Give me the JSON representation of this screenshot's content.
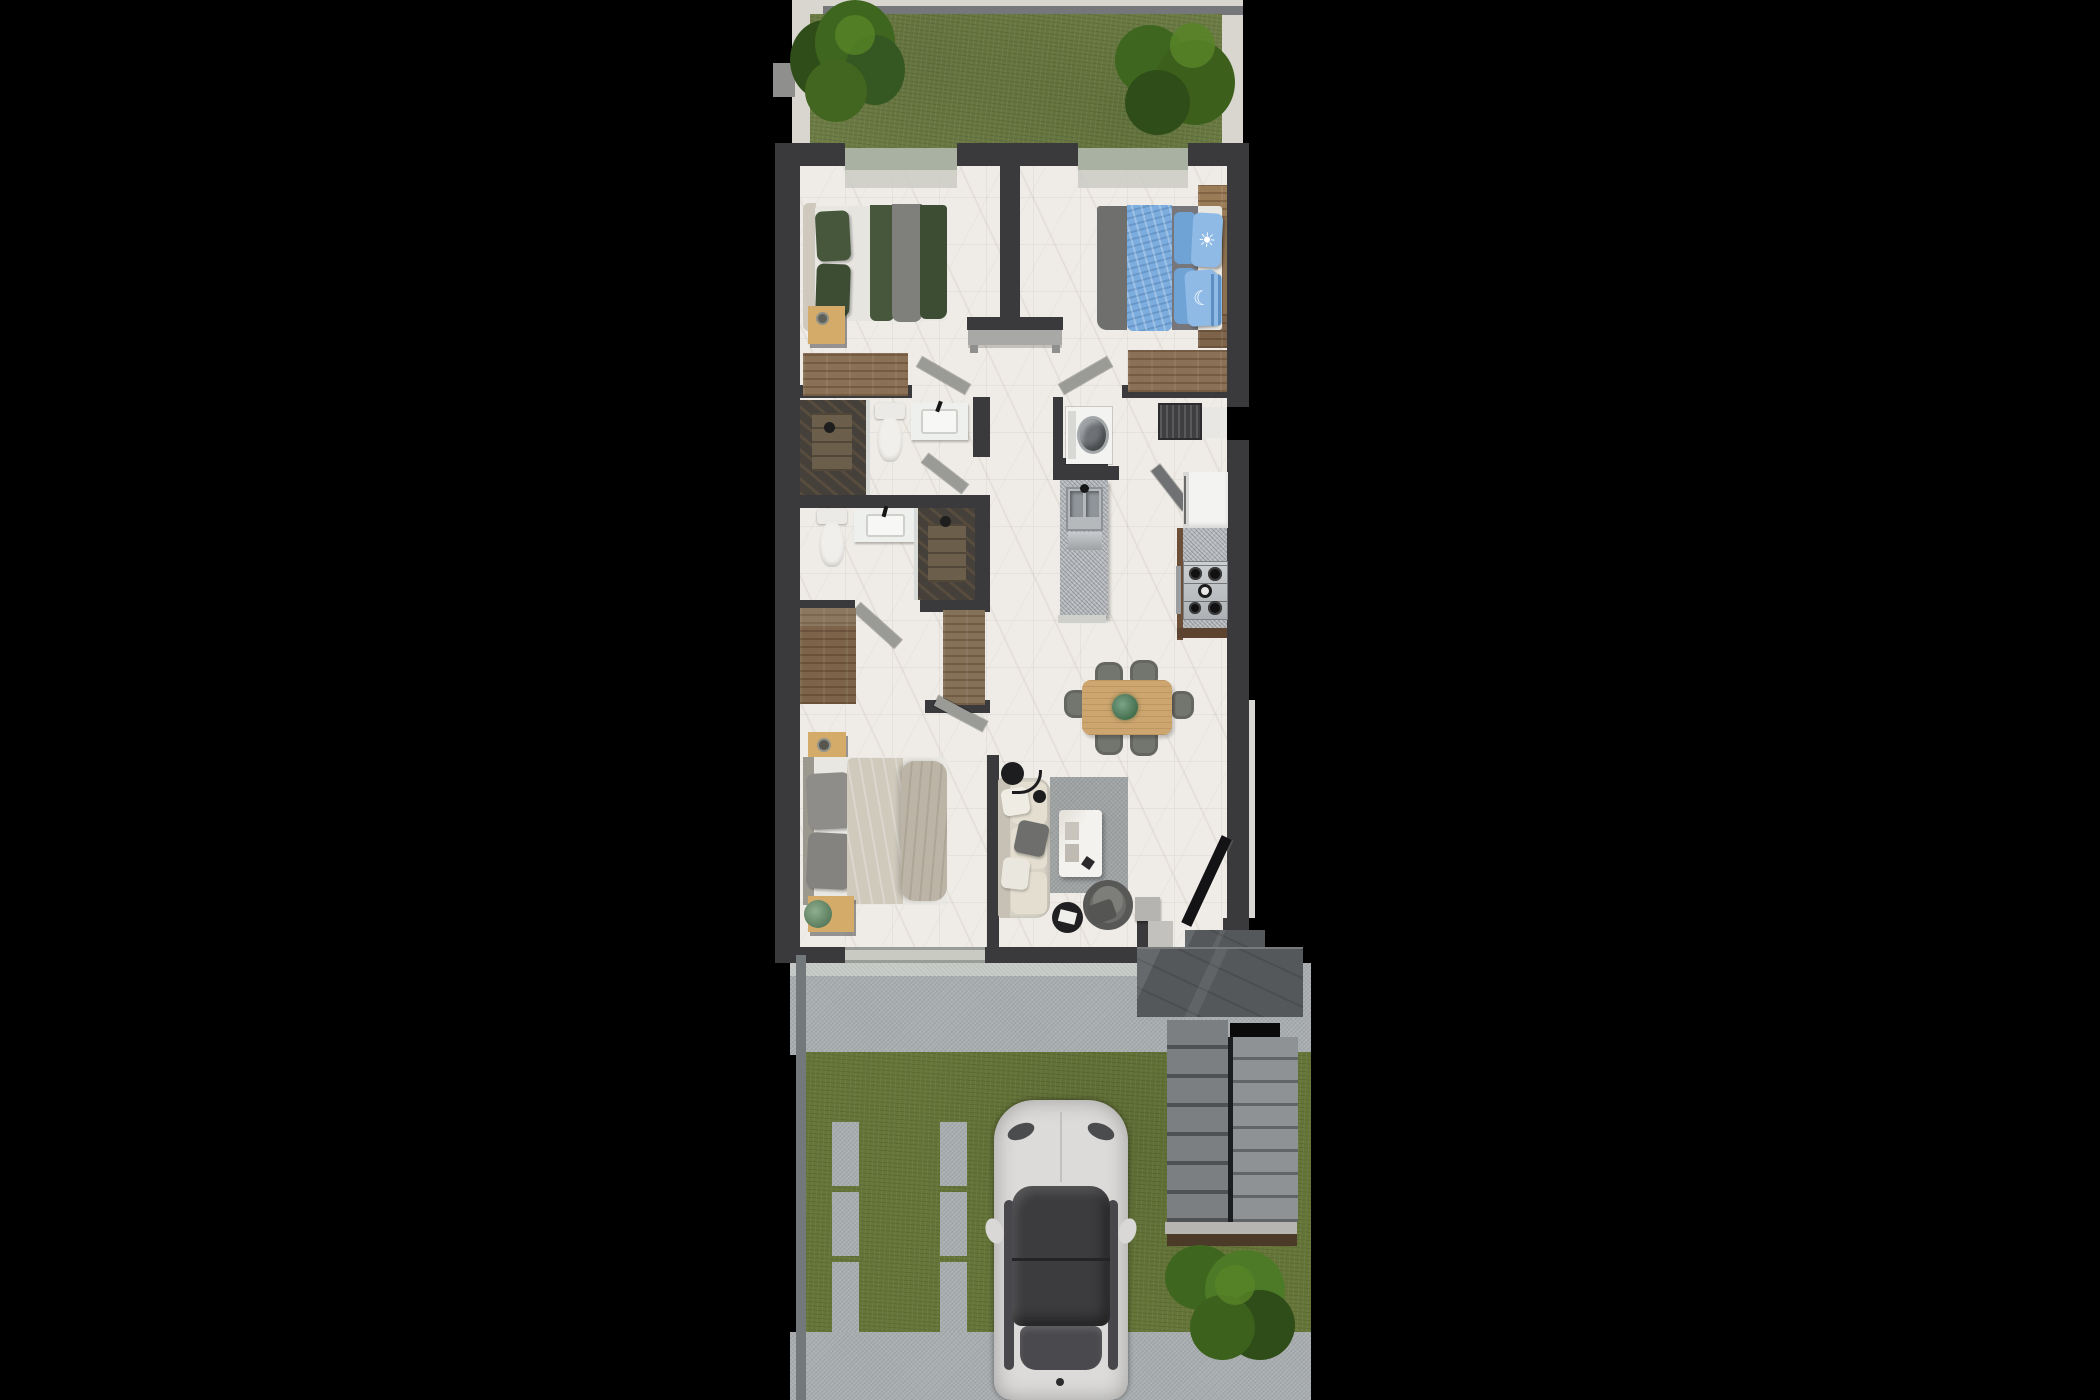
{
  "scene": {
    "type": "architectural-floor-plan-3d-render",
    "view": "top-down",
    "background": "#000000",
    "lot_orientation": "vertical, backyard at top, driveway and street side at bottom"
  },
  "palette": {
    "bg": "#000000",
    "wall": "#3a393b",
    "floor": "#efece7",
    "glass": "#a9b1a3",
    "glassSill": "#c9cbc3",
    "frameWhite": "#d9d6d0",
    "grassBack": "#6f7f46",
    "grassFront": "#667639",
    "treeDark": "#2f4d18",
    "tree": "#3f661f",
    "treeLight": "#578427",
    "concrete": "#a9aeb0",
    "terrazzo": "#c9cdc9",
    "stone": "#55585b",
    "stair1": "#7b7f81",
    "stair2": "#8e9294",
    "landing": "#b7b5b1",
    "landingWood": "#4c3a29",
    "woodPlank": "#8a7054",
    "woodWarm": "#cda56e",
    "woodLight": "#d4ab69",
    "steel": "#b5b9bc",
    "granite": "#b7babd",
    "showerTile": "#45403a",
    "showerTileLight": "#6b5f4b",
    "bedGreen": "#46573c",
    "bedGreenDark": "#3c4d33",
    "bedWhite": "#e9e7e2",
    "bedGray": "#7f7f7b",
    "bedBlue": "#7cadde",
    "pillowBlue": "#8fbae6",
    "duvetBeige": "#d0cabd",
    "duvetBeige2": "#bcb5a7",
    "sofaCream": "#d8d3c7",
    "cushion": "#e3decf",
    "rug": "#9fa3a4",
    "chairGray": "#73756f",
    "doorLeaf": "#9a9b97",
    "benchGray": "#a8a8a6",
    "applianceWhite": "#f3f3f1",
    "carBody": "#dcdbd9",
    "carGlass": "#3c3c3e",
    "black": "#141416"
  },
  "decor": {
    "sun_pillow_glyph": "☀",
    "moon_pillow_glyph": "☾"
  },
  "rooms": [
    {
      "name": "backyard",
      "features": [
        "lawn",
        "tree",
        "shrub",
        "white paver border"
      ]
    },
    {
      "name": "bedroom-1",
      "features": [
        "double bed green bedding",
        "nightstand",
        "wood dresser",
        "window"
      ]
    },
    {
      "name": "bedroom-2",
      "features": [
        "double bed blue bedding",
        "sun pillow",
        "moon pillow",
        "corner wood bench",
        "wood dresser",
        "window"
      ]
    },
    {
      "name": "hallway",
      "features": [
        "console bench"
      ]
    },
    {
      "name": "bathroom-1",
      "features": [
        "walk-in shower",
        "toilet",
        "vanity sink"
      ]
    },
    {
      "name": "bathroom-2",
      "features": [
        "toilet",
        "vanity sink",
        "walk-in shower"
      ]
    },
    {
      "name": "laundry-closet",
      "features": [
        "washing machine",
        "vent grille",
        "service hatch"
      ]
    },
    {
      "name": "kitchen",
      "features": [
        "island with double sink",
        "refrigerator",
        "gas stove",
        "granite counter"
      ]
    },
    {
      "name": "dining-area",
      "features": [
        "wood table",
        "six chairs",
        "centerpiece plant"
      ]
    },
    {
      "name": "closet-area",
      "features": [
        "two wardrobes"
      ]
    },
    {
      "name": "master-bedroom",
      "features": [
        "double bed beige bedding",
        "two nightstands",
        "plant"
      ]
    },
    {
      "name": "living-room",
      "features": [
        "sofa",
        "rug",
        "coffee table",
        "floor lamp",
        "armchair",
        "round side table",
        "wall tv"
      ]
    },
    {
      "name": "entry",
      "features": [
        "step",
        "threshold"
      ]
    },
    {
      "name": "front-patio",
      "features": [
        "dark stone slab"
      ]
    },
    {
      "name": "exterior-stairs",
      "features": [
        "two flights",
        "landing",
        "wood edge"
      ]
    },
    {
      "name": "driveway",
      "features": [
        "lawn with concrete strips",
        "white car",
        "shrub",
        "sidewalk"
      ]
    }
  ]
}
